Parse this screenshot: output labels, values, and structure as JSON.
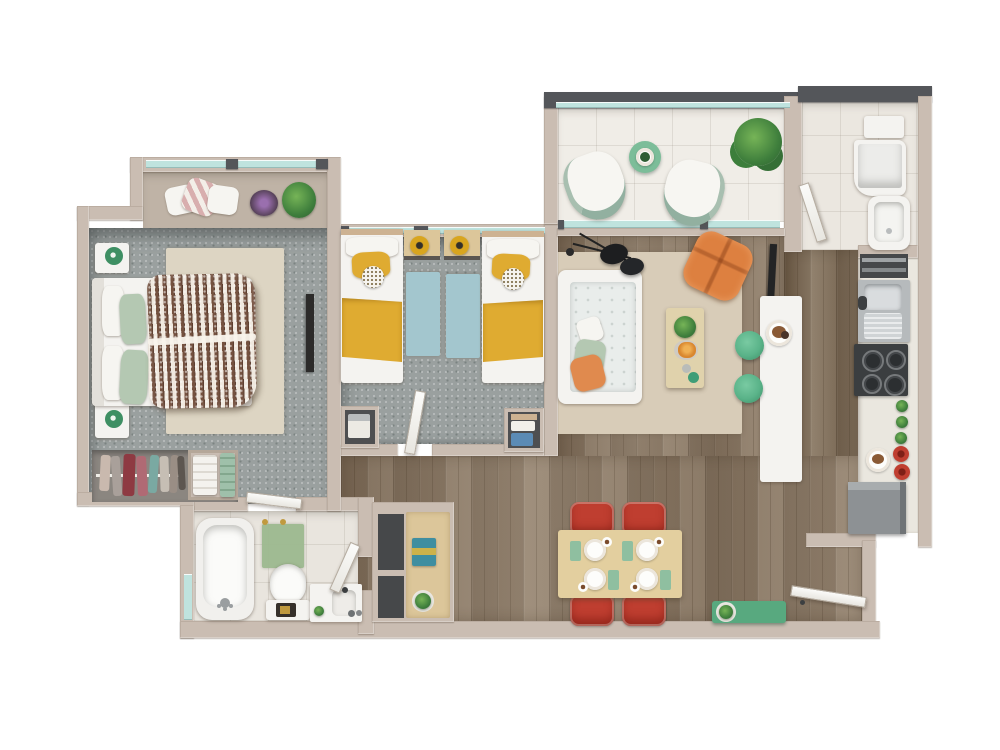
{
  "title": "3d-apartment-floor-plan-top-view",
  "canvas": {
    "width": 1000,
    "height": 750
  },
  "palette": {
    "background": "#ffffff",
    "wall": "#cabdb2",
    "wall-dark": "#54565a",
    "window-glass": "#bfe3de",
    "carpet": "#9aa09f",
    "wood": "#8b7a67",
    "wood-dark": "#7b6a56",
    "tile": "#f0ede7",
    "bath-tile": "#e9e5de",
    "rug-beige": "#ddd5c3",
    "rug-living": "#d8ccb8",
    "rug-blue": "#a3c6ce",
    "furniture-white": "#f4f3f0",
    "sofa-seat": "#e9edeb",
    "accent-green": "#5ab389",
    "sage": "#b4c8b2",
    "yellow": "#dfab31",
    "orange": "#dd8040",
    "red": "#bf3e30",
    "duvet-brown": "#74513f",
    "appliance-gray": "#8d9194",
    "appliance-dark": "#45484b",
    "desk-wood": "#dcc69a",
    "table-wood": "#e3cf9f"
  },
  "rooms": [
    {
      "id": "master-bedroom",
      "floor": "gray-carpet",
      "items": [
        "double-bed",
        "patterned-duvet",
        "sage-pillows",
        "nightstand-left-top",
        "nightstand-left-bottom",
        "green-table-lamps",
        "beige-area-rug",
        "wall-tv",
        "open-wardrobe-clothes",
        "towel-shelf",
        "window-bench-pillows",
        "purple-plant",
        "green-plant"
      ]
    },
    {
      "id": "kids-bedroom",
      "floor": "gray-carpet",
      "items": [
        "twin-bed-left",
        "twin-bed-right",
        "yellow-blankets",
        "polka-dot-pillows",
        "desk-left",
        "desk-right",
        "yellow-stools",
        "blue-rug-left",
        "blue-rug-right",
        "storage-niche-left",
        "storage-niche-right"
      ]
    },
    {
      "id": "balcony",
      "floor": "white-tile",
      "items": [
        "fan-lounge-chair-left",
        "fan-lounge-chair-right",
        "round-green-table",
        "large-potted-plant"
      ]
    },
    {
      "id": "laundry-room",
      "floor": "tile",
      "items": [
        "wall-shelf",
        "washing-machine",
        "utility-sink"
      ]
    },
    {
      "id": "kitchen",
      "floor": "wood",
      "items": [
        "open-shelf-unit",
        "double-basin-sink",
        "four-burner-stove",
        "counter-groceries",
        "red-pots",
        "food-plate",
        "refrigerator"
      ]
    },
    {
      "id": "living-room",
      "floor": "wood",
      "items": [
        "white-tufted-sofa",
        "throw-pillows",
        "double-disc-floor-lamp",
        "coffee-table",
        "table-plant",
        "orange-lounge-chair",
        "tv-panel",
        "breakfast-counter",
        "green-bar-stools",
        "snack-plate"
      ]
    },
    {
      "id": "dining-area",
      "floor": "wood",
      "items": [
        "dining-table",
        "red-chair-x4",
        "place-setting-x4",
        "green-shoe-bench",
        "bench-plant",
        "entry-door"
      ]
    },
    {
      "id": "bathroom",
      "floor": "tile",
      "items": [
        "bathtub",
        "green-bath-mat",
        "toilet",
        "vanity-sink",
        "window",
        "door"
      ]
    },
    {
      "id": "hallway",
      "floor": "wood",
      "items": [
        "storage-niches",
        "console-with-towels",
        "console-plant",
        "doors"
      ]
    }
  ]
}
